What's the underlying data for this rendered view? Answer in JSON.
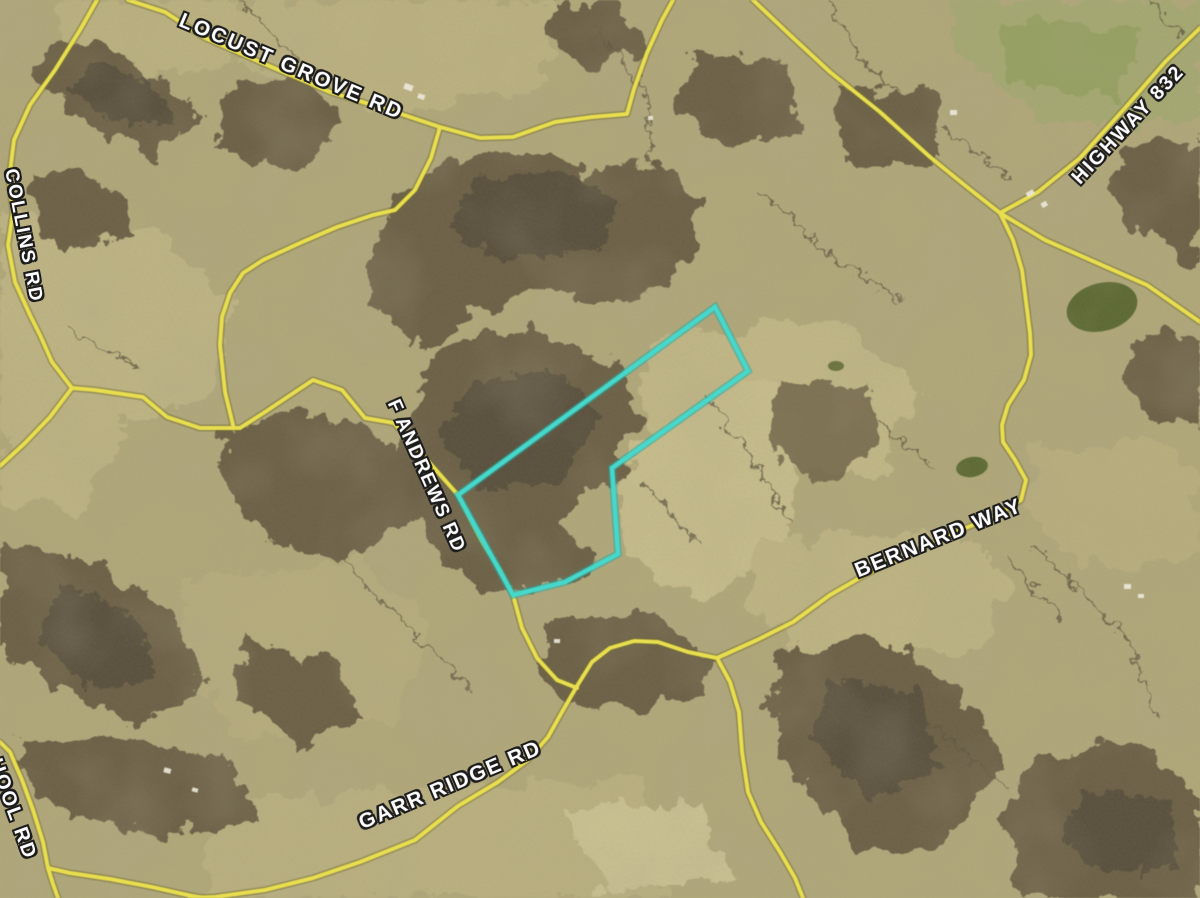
{
  "map": {
    "type": "aerial-satellite-map",
    "title": "Aerial parcel map with road overlay and highlighted property boundary",
    "parcel": {
      "description": "Highlighted property boundary polygon (irregular shape with notch at southeast)",
      "boundary_color": "#45d8cb"
    },
    "road_labels": [
      {
        "id": "locust-grove-rd",
        "text": "LOCUST GROVE RD"
      },
      {
        "id": "collins-rd",
        "text": "COLLINS RD"
      },
      {
        "id": "highway-832",
        "text": "HIGHWAY 832"
      },
      {
        "id": "f-andrews-rd",
        "text": "F ANDREWS RD"
      },
      {
        "id": "bernard-way",
        "text": "BERNARD WAY"
      },
      {
        "id": "garr-ridge-rd",
        "text": "GARR RIDGE RD"
      },
      {
        "id": "school-rd-partial",
        "text": "HOOL RD"
      }
    ],
    "colors": {
      "road_fill": "#e8de4e",
      "road_casing": "#6f6a30",
      "parcel_boundary": "#45d8cb",
      "parcel_boundary_halo": "#2aa69c",
      "terrain_base": "#b2a97b",
      "woodland": "#6a5f45",
      "woodland_dark": "#574e3a",
      "pond": "#5a6830",
      "building": "#ece8da",
      "label_text": "#fdfdfd",
      "label_outline": "#1c1c1c"
    }
  }
}
